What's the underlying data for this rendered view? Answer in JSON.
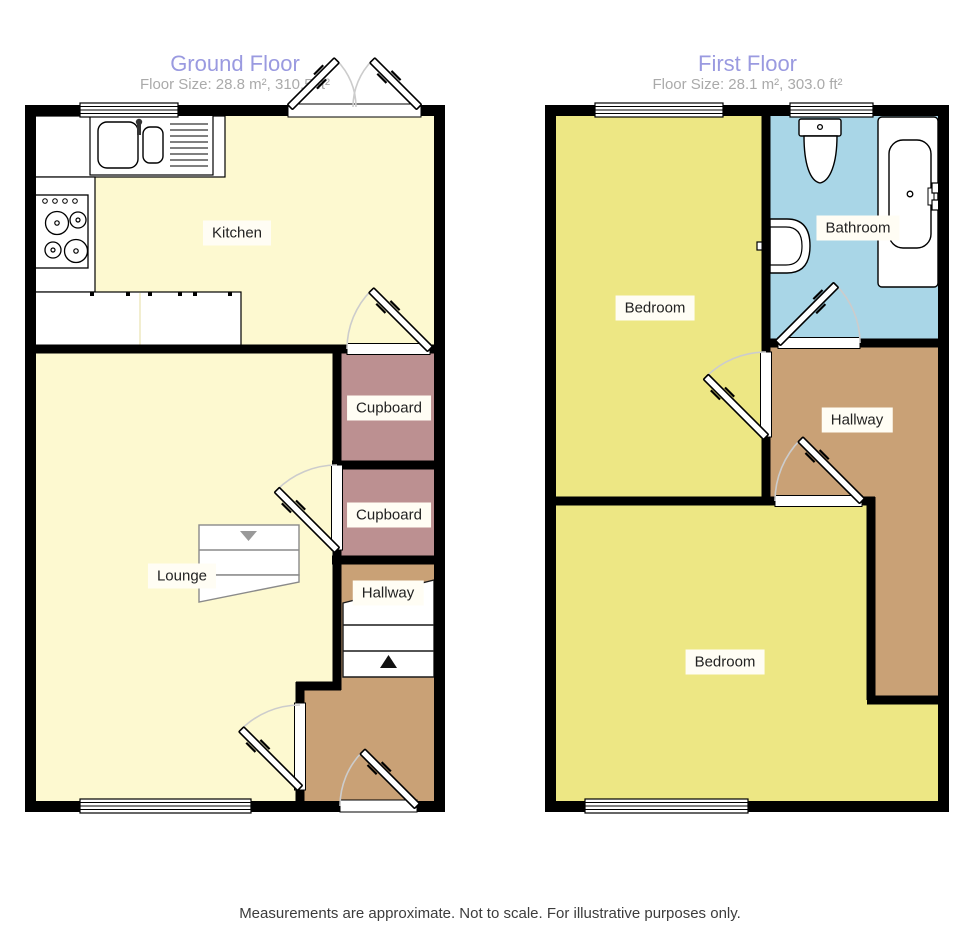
{
  "ground_floor": {
    "title": "Ground Floor",
    "floor_size": "Floor Size: 28.8 m², 310.5 ft²",
    "labels": {
      "kitchen": "Kitchen",
      "cupboard_top": "Cupboard",
      "cupboard_bottom": "Cupboard",
      "hallway": "Hallway",
      "lounge": "Lounge"
    }
  },
  "first_floor": {
    "title": "First Floor",
    "floor_size": "Floor Size: 28.1 m², 303.0 ft²",
    "labels": {
      "bedroom_top": "Bedroom",
      "bathroom": "Bathroom",
      "hallway": "Hallway",
      "bedroom_bottom": "Bedroom"
    }
  },
  "footer": {
    "disclaimer": "Measurements are approximate. Not to scale. For illustrative purposes only."
  },
  "colors": {
    "wall": "#000000",
    "ground_room": "#fdf9d0",
    "first_room": "#ede784",
    "cupboard": "#bc9091",
    "hallway": "#c9a176",
    "bathroom": "#a9d6e7",
    "fixture": "#ffffff",
    "door_arc": "#cccccc",
    "stair_outline": "#8a8a8a",
    "title": "#9a9ae0",
    "subtitle": "#aaaaaa",
    "label_bg": "#fffdf4",
    "label_text": "#222222"
  }
}
